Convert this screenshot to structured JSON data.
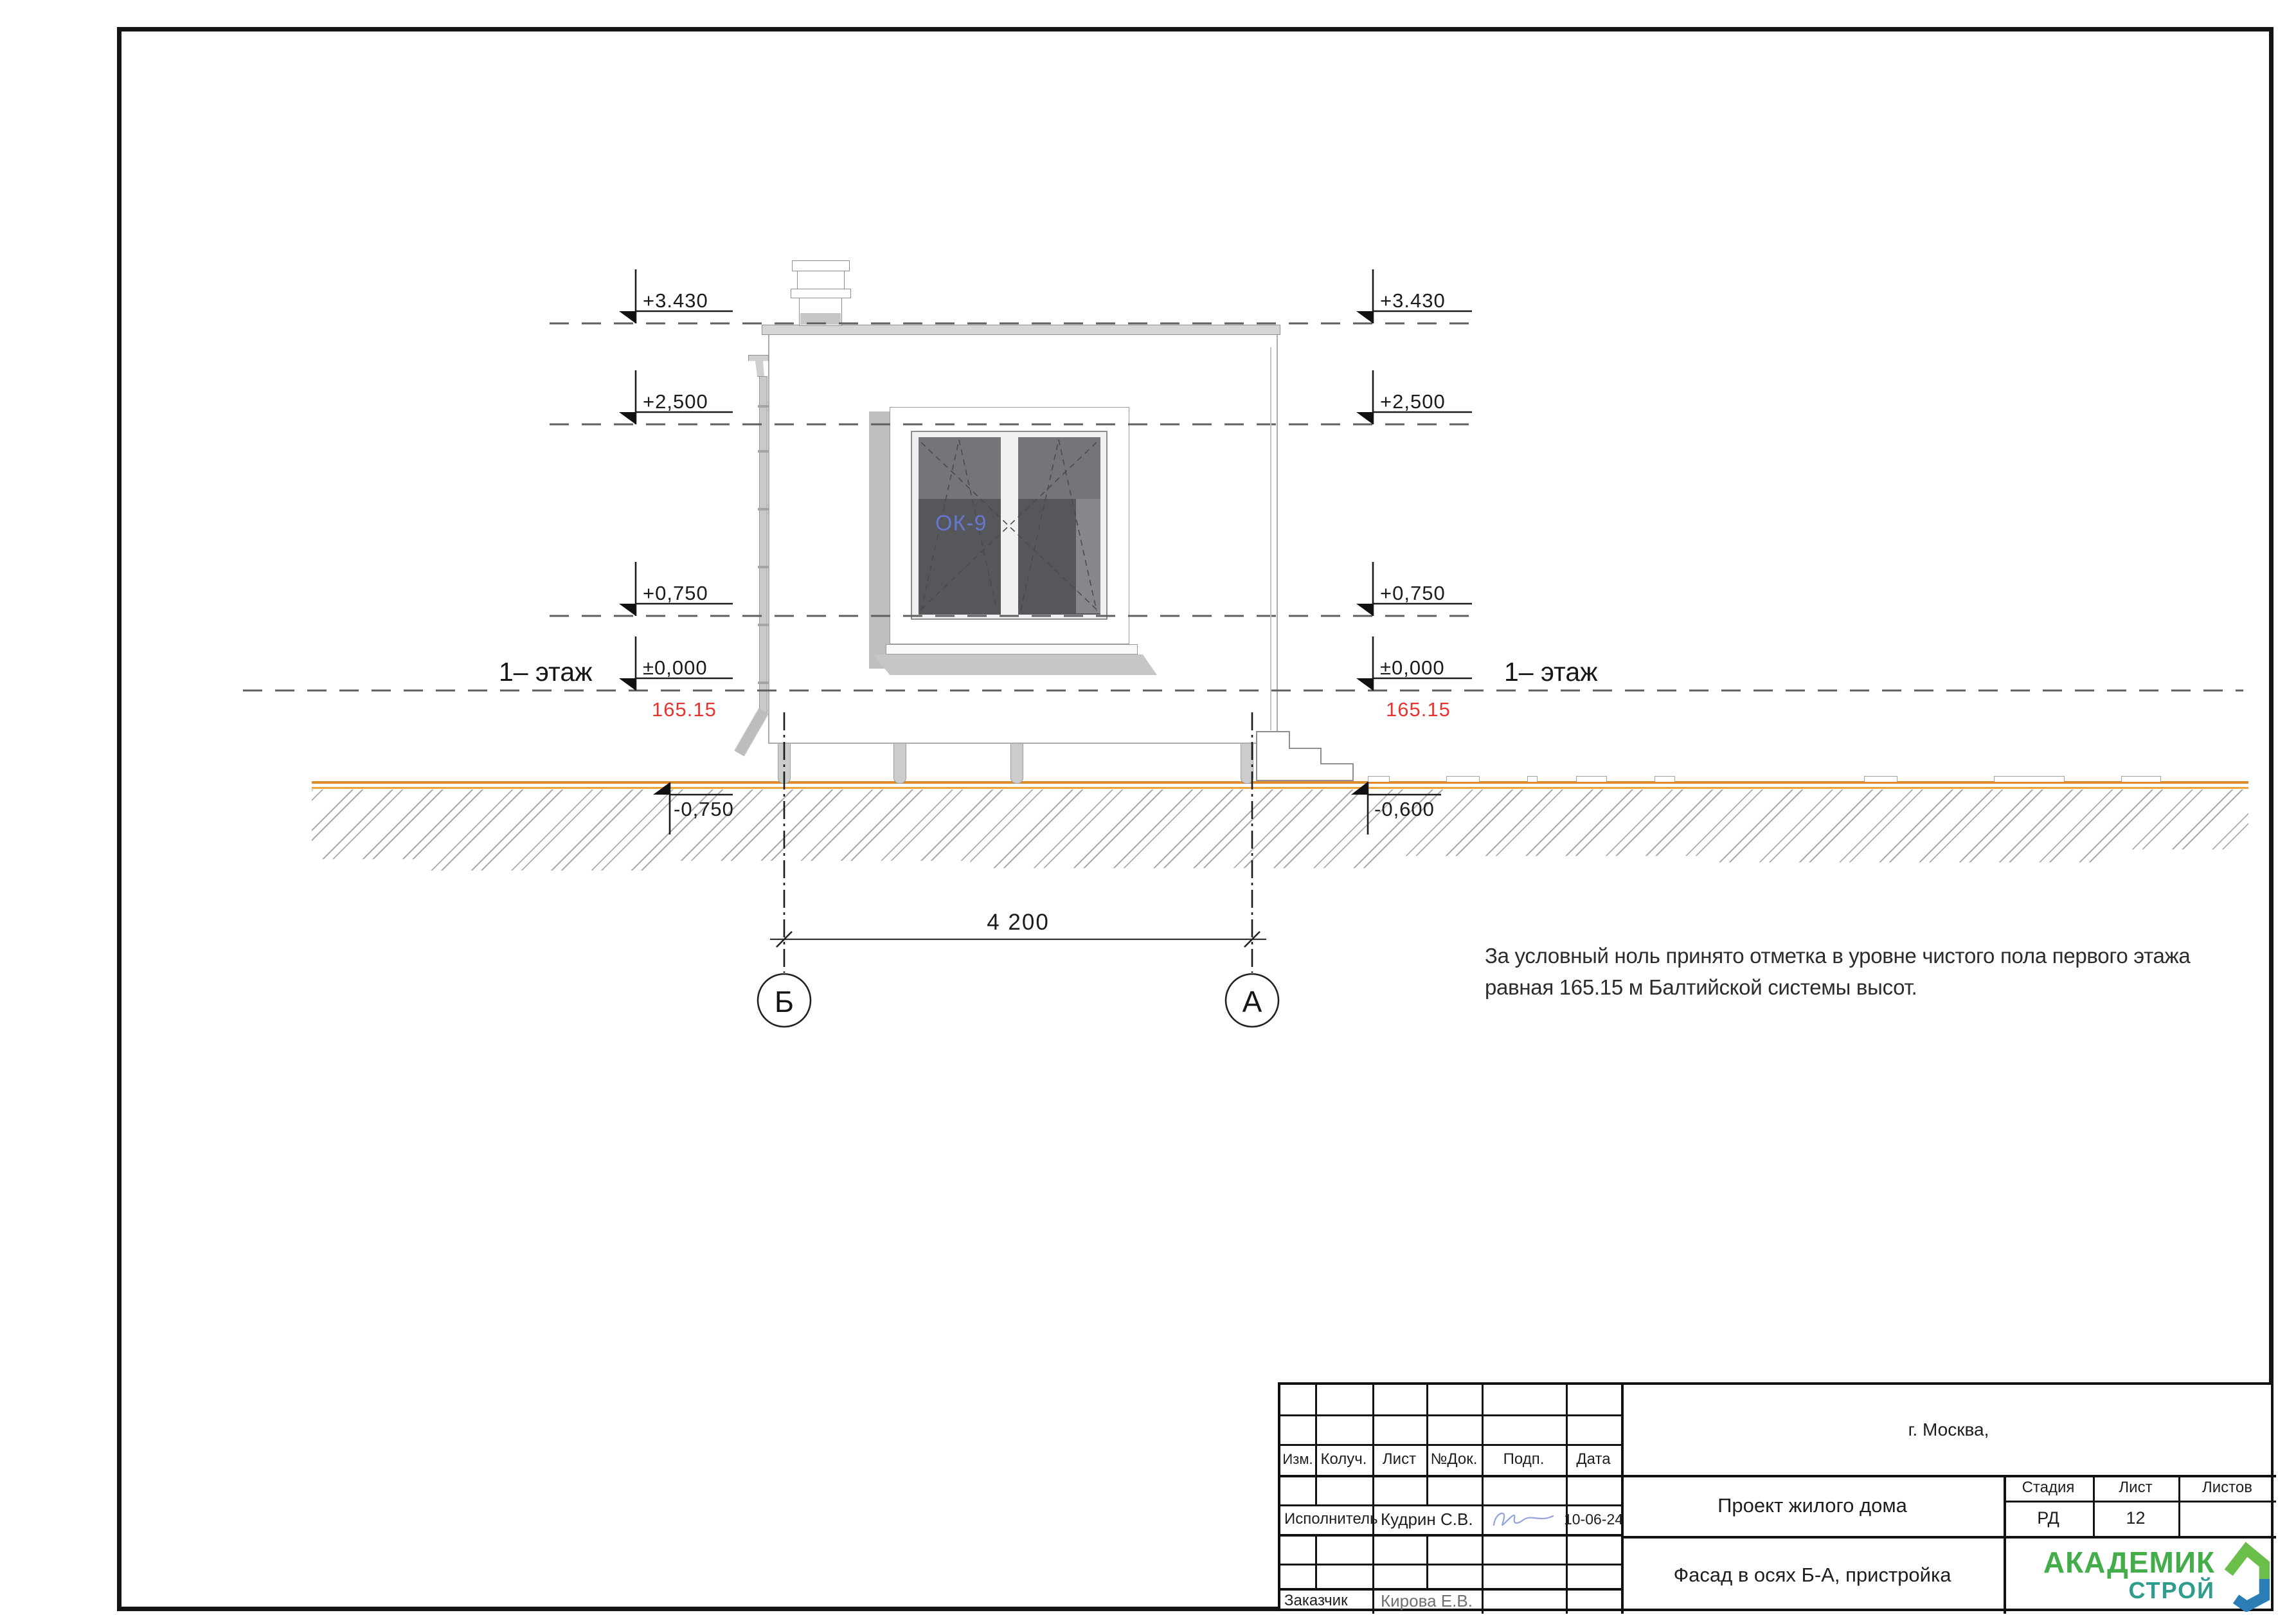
{
  "marks": {
    "left": [
      "+3.430",
      "+2,500",
      "+0,750",
      "±0,000"
    ],
    "right": [
      "+3.430",
      "+2,500",
      "+0,750",
      "±0,000"
    ],
    "below_left": "-0,750",
    "below_right": "-0,600",
    "datum_left": "165.15",
    "datum_right": "165.15",
    "floor_left": "1– этаж",
    "floor_right": "1– этаж"
  },
  "window": {
    "label": "ОК-9"
  },
  "dimension": {
    "value": "4 200"
  },
  "axes": {
    "left": "Б",
    "right": "А"
  },
  "note": {
    "line1": "За условный ноль принято отметка в уровне чистого пола первого этажа",
    "line2": "равная 165.15 м Балтийской системы высот."
  },
  "titleblock": {
    "headers": {
      "izm": "Изм.",
      "koluch": "Колуч.",
      "list": "Лист",
      "ndok": "№Док.",
      "podp": "Подп.",
      "data": "Дата"
    },
    "executor_label": "Исполнитель",
    "executor_name": "Кудрин С.В.",
    "executor_date": "10-06-24",
    "client_label": "Заказчик",
    "client_name": "Кирова Е.В.",
    "city": "г. Москва,",
    "project": "Проект жилого дома",
    "stage_header": "Стадия",
    "sheet_header": "Лист",
    "sheets_header": "Листов",
    "stage": "РД",
    "sheet": "12",
    "sheets": "",
    "doc_title": "Фасад в осях Б-А, пристройка",
    "logo_line1": "АКАДЕМИК",
    "logo_line2": "СТРОЙ"
  },
  "colors": {
    "ground_orange": "#df8a28",
    "ground_orange2": "#eda43c",
    "datum_red": "#e53530",
    "window_tag_blue": "#6577cf",
    "logo_green": "#43ad4a",
    "logo_teal": "#2f9d8e",
    "signature_blue": "#95a3dd"
  }
}
